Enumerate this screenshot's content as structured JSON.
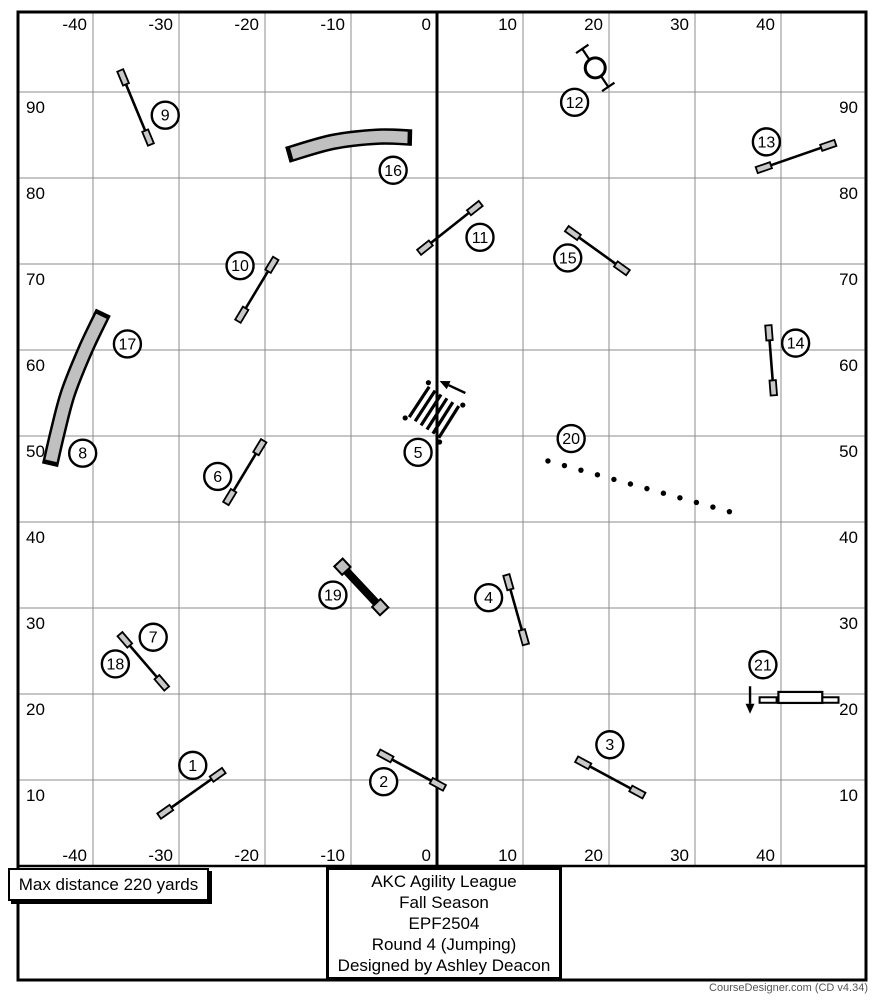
{
  "boxes": {
    "max_distance": "Max distance 220 yards",
    "info_lines": [
      "AKC Agility League",
      "Fall Season",
      "EPF2504",
      "Round 4 (Jumping)",
      "Designed by Ashley Deacon"
    ]
  },
  "footer": {
    "credit": "CourseDesigner.com (CD v4.34)"
  },
  "colors": {
    "grid_line": "#8c8c8c",
    "axis_line": "#000000",
    "tunnel_fill": "#c0c0c0",
    "wing_fill": "#c8c8c8",
    "white_fill": "#ffffff",
    "pole_dot": "#000000",
    "credit_text": "#565656"
  },
  "chart_data": {
    "type": "scatter",
    "title": "AKC Agility League Fall Season EPF2504 Round 4 (Jumping) course map",
    "units": "yards",
    "x_ticks": [
      -40,
      -30,
      -20,
      -10,
      0,
      10,
      20,
      30,
      40
    ],
    "y_ticks": [
      90,
      80,
      70,
      60,
      50,
      40,
      30,
      20,
      10
    ],
    "x_range": [
      -48.7,
      49.9
    ],
    "y_range": [
      0,
      99.3
    ],
    "grid": "on",
    "obstacles": [
      {
        "num": 1,
        "type": "jump",
        "from": [
          -31.6,
          6.3
        ],
        "to": [
          -25.5,
          10.6
        ],
        "label": [
          -28.4,
          11.7
        ]
      },
      {
        "num": 2,
        "type": "jump",
        "from": [
          -6.0,
          12.8
        ],
        "to": [
          0.1,
          9.5
        ],
        "label": [
          -6.2,
          9.8
        ]
      },
      {
        "num": 3,
        "type": "jump",
        "from": [
          17.0,
          12.0
        ],
        "to": [
          23.3,
          8.6
        ],
        "label": [
          20.1,
          14.1
        ]
      },
      {
        "num": 4,
        "type": "jump",
        "from": [
          8.3,
          33.0
        ],
        "to": [
          10.1,
          26.6
        ],
        "label": [
          6.0,
          31.2
        ]
      },
      {
        "num": 5,
        "type": "broad_jump",
        "corners": [
          [
            -3.7,
            52.1
          ],
          [
            -1.0,
            56.2
          ],
          [
            3.0,
            53.6
          ],
          [
            0.3,
            49.3
          ]
        ],
        "boards": 6,
        "arrow": {
          "from": [
            3.3,
            55.0
          ],
          "to": [
            0.3,
            56.4
          ]
        },
        "label": [
          -2.2,
          48.1
        ]
      },
      {
        "num": 6,
        "type": "jump",
        "from": [
          -20.6,
          48.7
        ],
        "to": [
          -24.1,
          42.9
        ],
        "label": [
          -25.5,
          45.3
        ]
      },
      {
        "num": 7,
        "type": "jump",
        "from": [
          -36.3,
          26.3
        ],
        "to": [
          -32.0,
          21.3
        ],
        "label": [
          -33.0,
          26.6
        ]
      },
      {
        "num": 8,
        "type": "label_only",
        "label": [
          -41.2,
          48.0
        ]
      },
      {
        "num": 9,
        "type": "jump",
        "from": [
          -36.5,
          91.7
        ],
        "to": [
          -33.6,
          84.7
        ],
        "label": [
          -31.6,
          87.3
        ]
      },
      {
        "num": 10,
        "type": "jump",
        "from": [
          -19.2,
          69.9
        ],
        "to": [
          -22.7,
          64.1
        ],
        "label": [
          -22.9,
          69.8
        ]
      },
      {
        "num": 11,
        "type": "jump",
        "from": [
          -1.4,
          71.9
        ],
        "to": [
          4.4,
          76.5
        ],
        "label": [
          5.0,
          73.1
        ]
      },
      {
        "num": 12,
        "type": "tire",
        "center": [
          18.4,
          92.8
        ],
        "label": [
          16.0,
          88.8
        ]
      },
      {
        "num": 13,
        "type": "jump",
        "from": [
          38.0,
          81.2
        ],
        "to": [
          45.5,
          83.8
        ],
        "label": [
          38.3,
          84.2
        ]
      },
      {
        "num": 14,
        "type": "jump",
        "from": [
          38.6,
          62.0
        ],
        "to": [
          39.1,
          55.6
        ],
        "label": [
          41.7,
          60.8
        ]
      },
      {
        "num": 15,
        "type": "jump",
        "from": [
          15.8,
          73.6
        ],
        "to": [
          21.5,
          69.5
        ],
        "label": [
          15.2,
          70.7
        ]
      },
      {
        "num": 16,
        "type": "tunnel",
        "path": [
          [
            -17.4,
            82.7
          ],
          [
            -12.1,
            84.2
          ],
          [
            -7.0,
            84.8
          ],
          [
            -2.9,
            84.7
          ]
        ],
        "label": [
          -5.1,
          80.9
        ]
      },
      {
        "num": 17,
        "type": "tunnel",
        "path": [
          [
            -38.8,
            64.4
          ],
          [
            -40.9,
            60.0
          ],
          [
            -42.9,
            55.0
          ],
          [
            -44.1,
            50.5
          ],
          [
            -45.0,
            46.6
          ]
        ],
        "label": [
          -36.0,
          60.7
        ]
      },
      {
        "num": 18,
        "type": "label_only",
        "label": [
          -37.4,
          23.5
        ]
      },
      {
        "num": 19,
        "type": "panel_jump",
        "from": [
          -11.0,
          34.8
        ],
        "to": [
          -6.6,
          30.1
        ],
        "label": [
          -12.1,
          31.5
        ]
      },
      {
        "num": 20,
        "type": "weave",
        "from": [
          12.9,
          47.1
        ],
        "to": [
          34.0,
          41.2
        ],
        "poles": 12,
        "label": [
          15.6,
          49.7
        ]
      },
      {
        "num": 21,
        "type": "spread_jump",
        "wings": [
          [
            38.5,
            19.3
          ],
          [
            45.7,
            19.3
          ]
        ],
        "bar": [
          [
            39.7,
            19.6
          ],
          [
            44.8,
            19.6
          ]
        ],
        "arrow": {
          "from": [
            36.4,
            20.9
          ],
          "to": [
            36.4,
            17.7
          ]
        },
        "label": [
          37.9,
          23.4
        ]
      }
    ]
  }
}
